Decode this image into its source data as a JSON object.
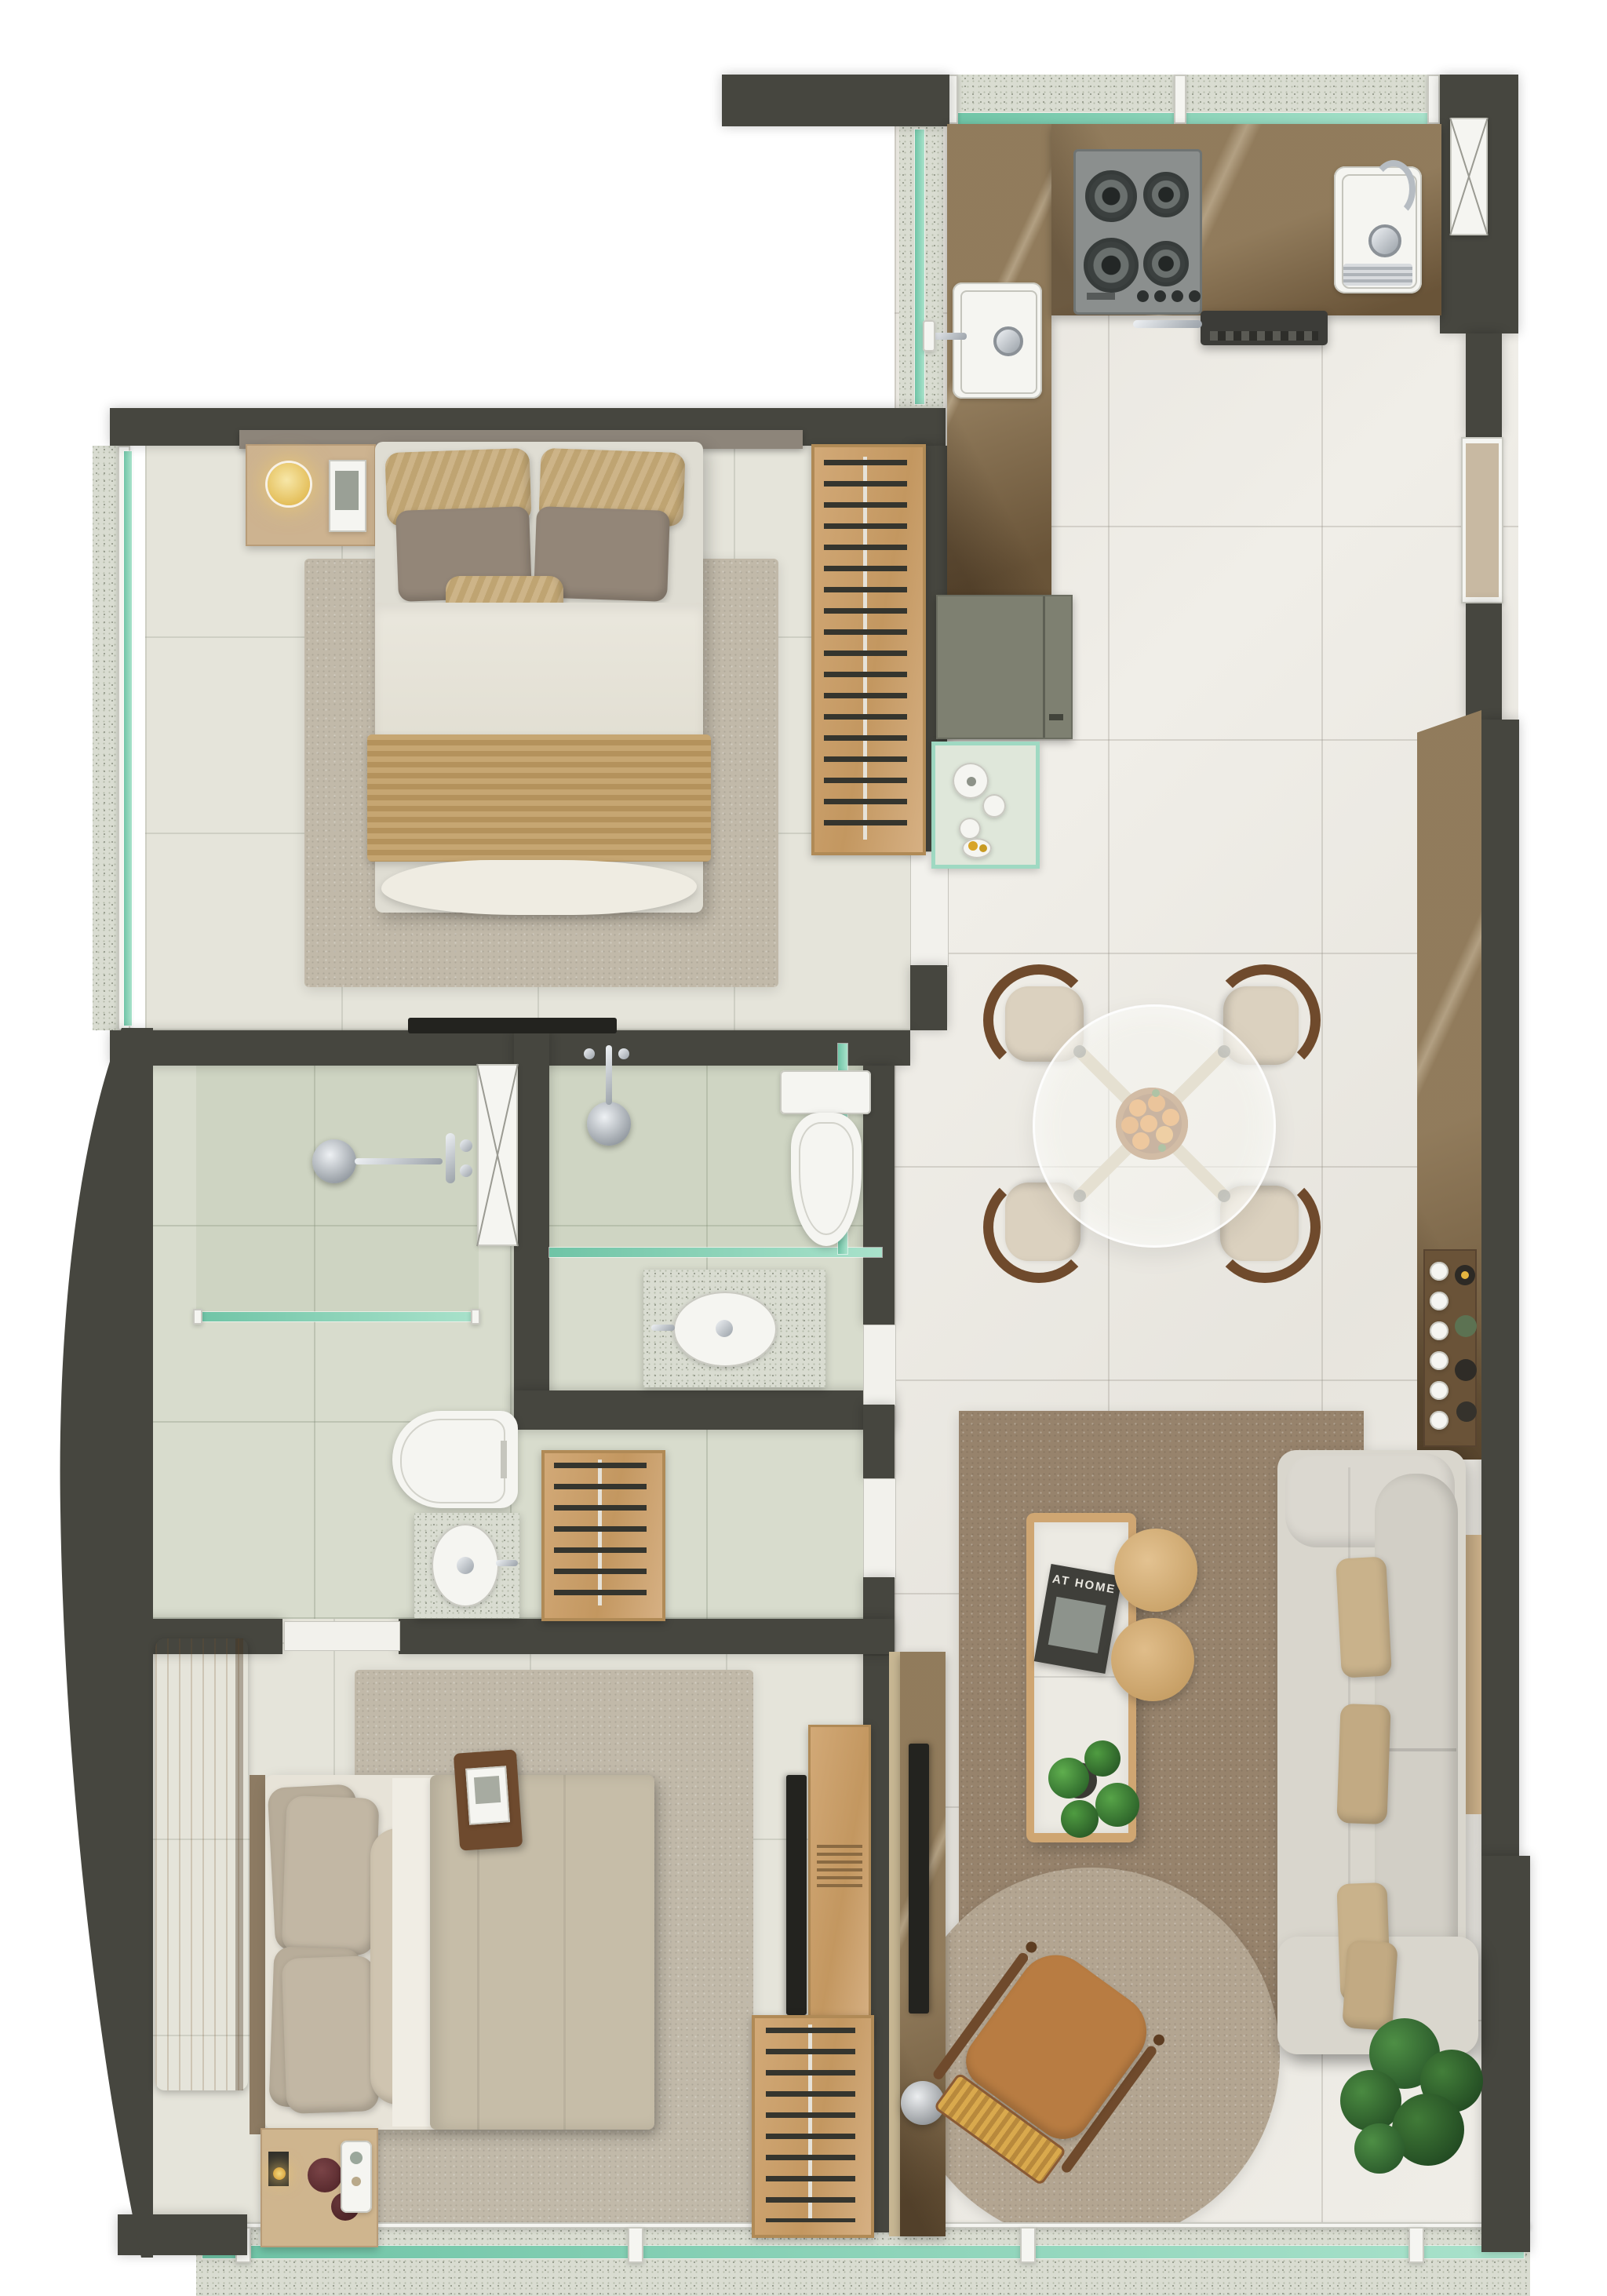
{
  "scene": {
    "type": "apartment floor plan rendering",
    "view": "top-down"
  },
  "texts": {
    "coffee_table_book": "AT HOME"
  },
  "colors": {
    "wall": "#46463f",
    "floor_light": "#f0eee8",
    "floor_beige": "#e5e4da",
    "floor_bath": "#d8dccd",
    "terrazzo": "#d9dcd1",
    "glass_teal": "#8fd8bd",
    "counter_brown": "#7c6545",
    "olive_cabinet": "#7e8071",
    "wood": "#cfa672",
    "hanger": "#35352e",
    "rug_brown": "#97836c",
    "rug_round": "#b3a591",
    "rug_beige": "#c1b9a9",
    "sofa": "#d9d6cd",
    "pillow_tan": "#c9b28b",
    "chair_caramel": "#b87c42",
    "rattan": "#d9a94d",
    "chair_wood": "#6f4a2c",
    "cushion": "#dbd1bf",
    "plant": "#3a7437",
    "accent_lamp": "#eed27f",
    "orange": "#e2892b",
    "tv": "#23231f",
    "white_fixture": "#f5f5f1",
    "chrome": "#aeb4ba"
  },
  "rooms": {
    "kitchen": {
      "items": [
        "gas-cooktop",
        "main-sink",
        "prep-sink",
        "range-hood",
        "refrigerator-niche",
        "l-counter",
        "bar-counter",
        "serving-tray",
        "olive-cabinet",
        "tea-table",
        "top-window",
        "side-window"
      ]
    },
    "dining_area": {
      "chairs": 4,
      "items": [
        "round-glass-table",
        "wood-cross-base",
        "fruit-bowl-oranges",
        "dining-chair"
      ]
    },
    "living_area": {
      "items": [
        "sofa",
        "throw-pillows",
        "brown-rug",
        "round-rug",
        "coffee-table",
        "book",
        "monstera-plant",
        "nesting-side-tables",
        "rattan-armchair",
        "potted-plant",
        "tv",
        "media-marble-panel",
        "decor-sphere",
        "wall-ledge"
      ]
    },
    "bedroom_top": {
      "items": [
        "double-bed",
        "striped-pillows",
        "nightstand",
        "sphere-lamp",
        "book",
        "area-rug",
        "open-wardrobe",
        "tv",
        "headboard"
      ]
    },
    "bathroom_main": {
      "items": [
        "rain-shower",
        "glass-screen",
        "shower-door-panel",
        "toilet",
        "terrazzo-vanity",
        "vessel-sink"
      ]
    },
    "bathroom_second": {
      "items": [
        "rain-shower",
        "glass-screen",
        "toilet",
        "terrazzo-vanity",
        "vessel-sink"
      ]
    },
    "bedroom_bottom": {
      "items": [
        "double-bed",
        "breakfast-tray",
        "nightstand",
        "candle",
        "flowers",
        "area-rug",
        "wood-bench",
        "open-wardrobe",
        "corridor-wardrobe",
        "tv-console",
        "tv"
      ]
    },
    "balcony": {
      "items": [
        "terrazzo-sill",
        "teal-window-glass",
        "window-posts"
      ]
    }
  }
}
